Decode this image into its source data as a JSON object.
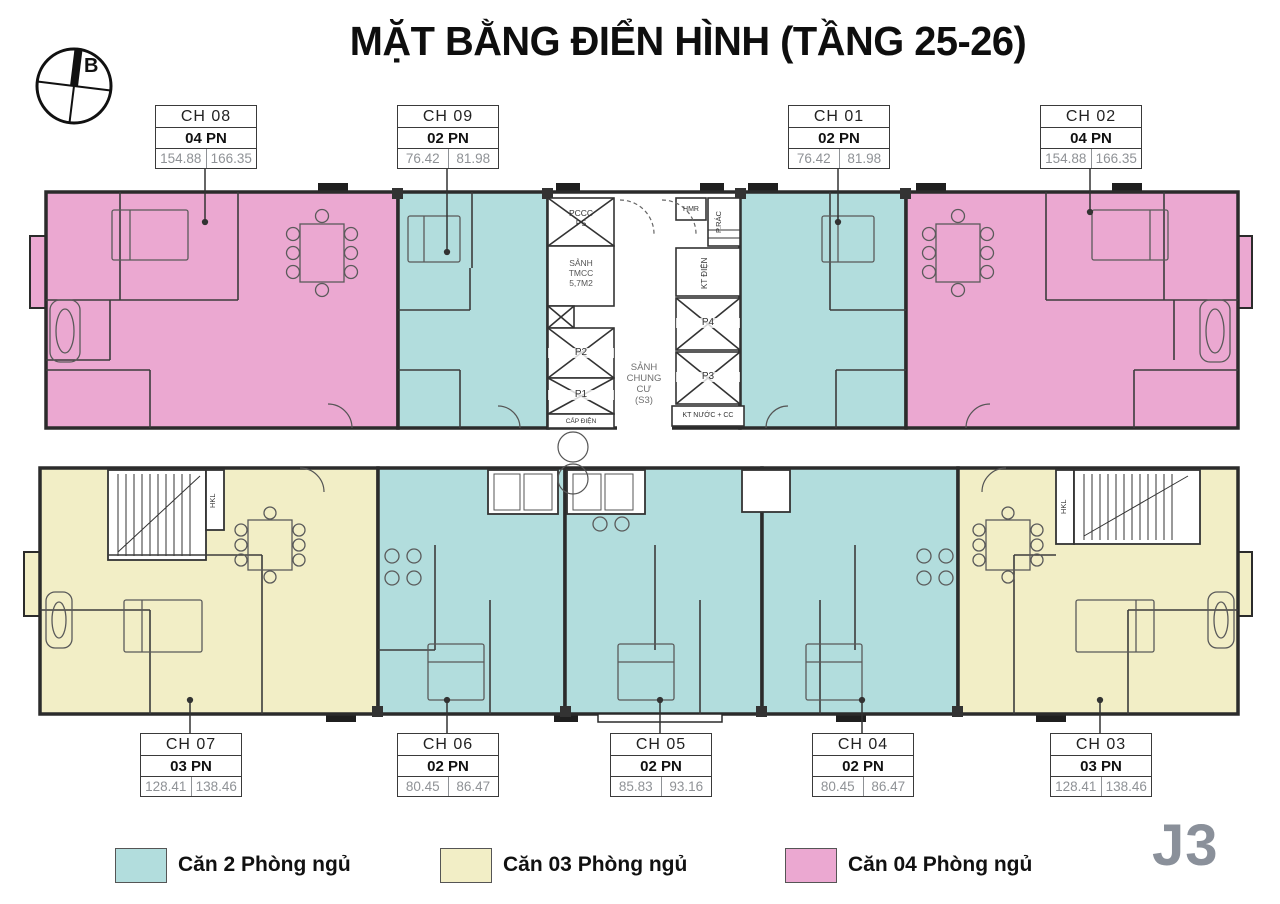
{
  "title": "MẶT BẰNG ĐIỂN HÌNH (TẦNG 25-26)",
  "compass": {
    "north_label": "B"
  },
  "block_label": "J3",
  "units_top": [
    {
      "id": "CH 08",
      "bedrooms": "04 PN",
      "area1": "154.88",
      "area2": "166.35"
    },
    {
      "id": "CH 09",
      "bedrooms": "02 PN",
      "area1": "76.42",
      "area2": "81.98"
    },
    {
      "id": "CH 01",
      "bedrooms": "02 PN",
      "area1": "76.42",
      "area2": "81.98"
    },
    {
      "id": "CH 02",
      "bedrooms": "04 PN",
      "area1": "154.88",
      "area2": "166.35"
    }
  ],
  "units_bottom": [
    {
      "id": "CH 07",
      "bedrooms": "03 PN",
      "area1": "128.41",
      "area2": "138.46"
    },
    {
      "id": "CH 06",
      "bedrooms": "02 PN",
      "area1": "80.45",
      "area2": "86.47"
    },
    {
      "id": "CH 05",
      "bedrooms": "02 PN",
      "area1": "85.83",
      "area2": "93.16"
    },
    {
      "id": "CH 04",
      "bedrooms": "02 PN",
      "area1": "80.45",
      "area2": "86.47"
    },
    {
      "id": "CH 03",
      "bedrooms": "03 PN",
      "area1": "128.41",
      "area2": "138.46"
    }
  ],
  "core": {
    "pccc": "PCCC\nP5",
    "fire_lobby": "SẢNH\nTMCC\n5,7M2",
    "lift_p2": "P2",
    "lift_p1": "P1",
    "cap_dien": "CẤP ĐIỆN",
    "main_lobby": "SẢNH\nCHUNG\nCƯ\n(S3)",
    "hmr": "HMR",
    "trash_room": "P.RÁC",
    "kt_dien": "KT ĐIỆN",
    "lift_p4": "P4",
    "lift_p3": "P3",
    "kt_nuoc": "KT NƯỚC + CC",
    "stair_left": "HKL",
    "stair_right": "HKL"
  },
  "legend": [
    {
      "label": "Căn 2 Phòng ngủ",
      "color": "#b2dddd"
    },
    {
      "label": "Căn 03 Phòng ngủ",
      "color": "#f2eec6"
    },
    {
      "label": "Căn 04 Phòng ngủ",
      "color": "#eba8d1"
    }
  ],
  "colors": {
    "two_bedroom": "#b2dddd",
    "three_bedroom": "#f2eec6",
    "four_bedroom": "#eba8d1",
    "wall": "#2b2b2b",
    "block_label": "#8a909a"
  }
}
